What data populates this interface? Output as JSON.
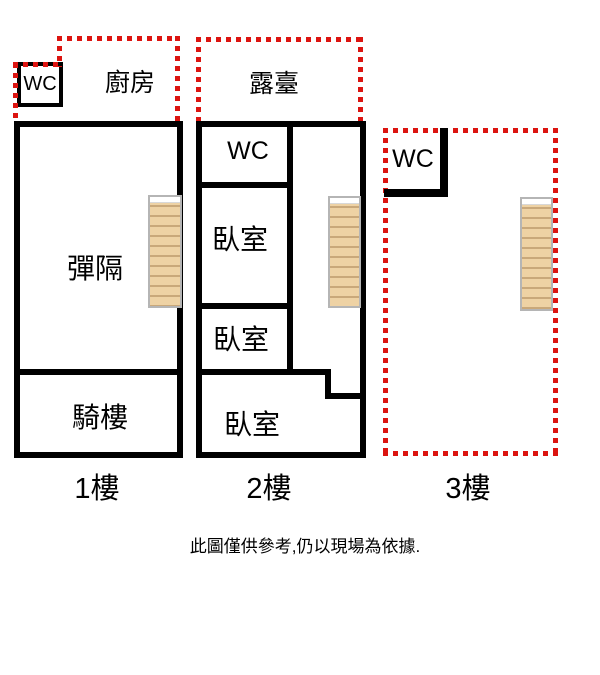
{
  "title": "三層樓平面圖",
  "colors": {
    "wall": "#000000",
    "dotted_outline": "#dc1410",
    "stair_fill": "#eed2a4",
    "stair_line": "#c9a87a",
    "stair_border": "#b5b5b5"
  },
  "floor1": {
    "label": "1樓",
    "wc": "WC",
    "kitchen": "廚房",
    "room_main": "彈隔",
    "arcade": "騎樓"
  },
  "floor2": {
    "label": "2樓",
    "terrace": "露臺",
    "wc": "WC",
    "bedroom_a": "臥室",
    "bedroom_b": "臥室",
    "bedroom_c": "臥室"
  },
  "floor3": {
    "label": "3樓",
    "wc": "WC"
  },
  "disclaimer": "此圖僅供參考,仍以現場為依據."
}
